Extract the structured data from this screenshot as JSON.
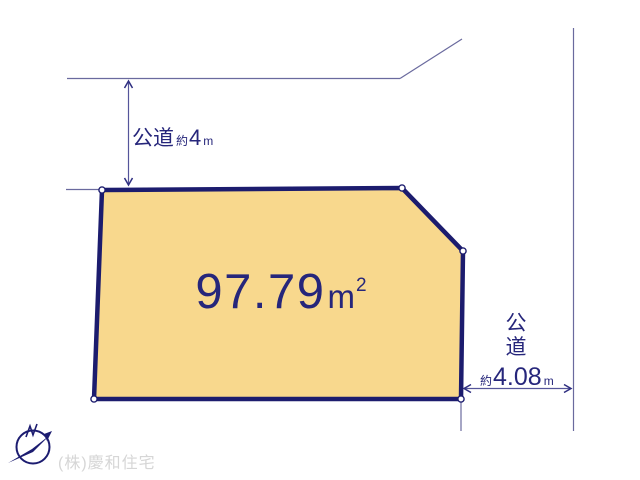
{
  "diagram_title": "lot-plan",
  "parcel": {
    "area_value": "97.79",
    "area_unit": "m",
    "area_sup": "2"
  },
  "road_top": {
    "name": "公道",
    "approx": "約",
    "value": "4",
    "unit": "m"
  },
  "road_right": {
    "name_vertical": "公\n道",
    "approx": "約",
    "value": "4.08",
    "unit": "m"
  },
  "footer": {
    "company": "(株)慶和住宅"
  },
  "colors": {
    "background": "#FFFFFF",
    "parcel_fill": "#F8D88D",
    "parcel_border": "#1C1C6E",
    "thin_line": "#6A6A9E",
    "dimension_arrow": "#2E2E80",
    "text_navy": "#26267B",
    "watermark_grey": "#D6D6D6"
  }
}
